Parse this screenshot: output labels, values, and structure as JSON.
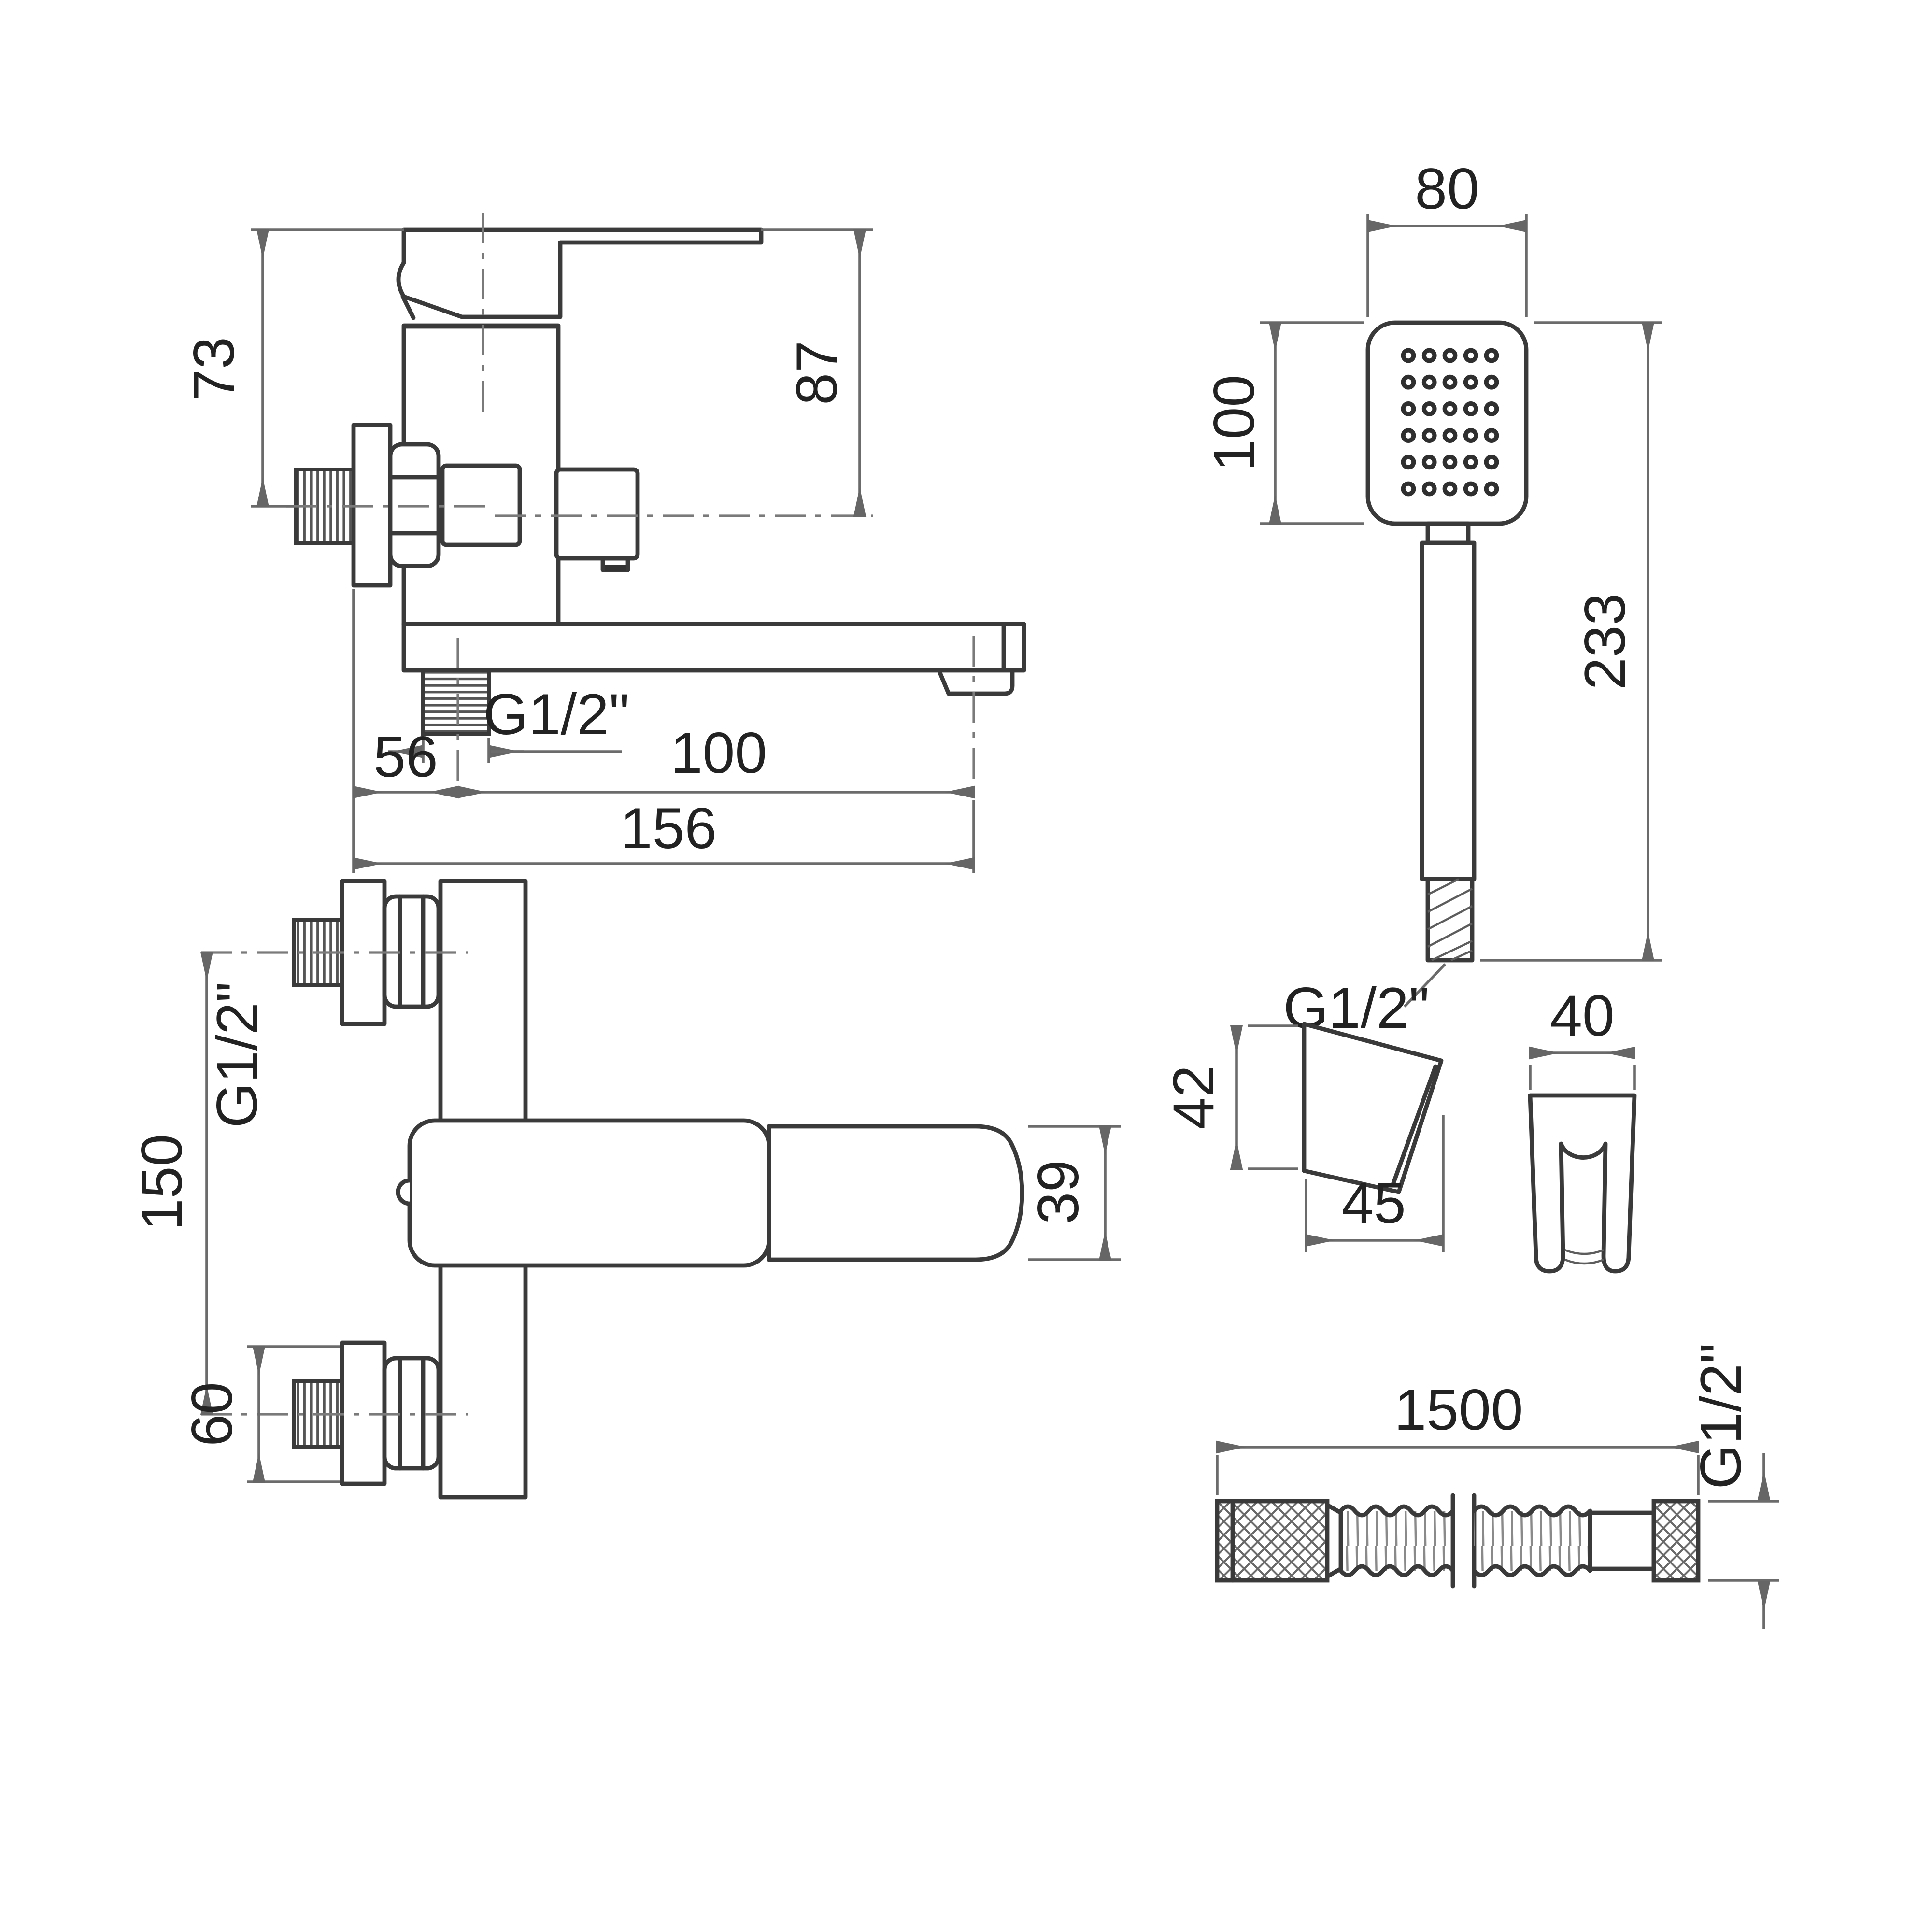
{
  "drawing": {
    "title": "Wall-mounted bath mixer with hand shower set — dimensional drawing",
    "units": "mm",
    "colors": {
      "line": "#3a3a3a",
      "dimension": "#6b6b6b",
      "text": "#222222",
      "background": "#ffffff"
    },
    "side_view": {
      "height_73": "73",
      "height_87": "87",
      "thread_label": "G1/2\"",
      "offset_56": "56",
      "spout_100": "100",
      "total_156": "156"
    },
    "shower_view": {
      "width_80": "80",
      "head_100": "100",
      "length_233": "233",
      "thread_label": "G1/2\"",
      "nozzle_grid": {
        "columns": 5,
        "rows": 6
      }
    },
    "plan_view": {
      "centers_150": "150",
      "flange_60": "60",
      "thread_label": "G1/2\"",
      "spout_39": "39"
    },
    "bracket_view": {
      "height_42": "42",
      "depth_45": "45",
      "width_40": "40"
    },
    "hose_view": {
      "length_1500": "1500",
      "thread_label": "G1/2\""
    }
  }
}
